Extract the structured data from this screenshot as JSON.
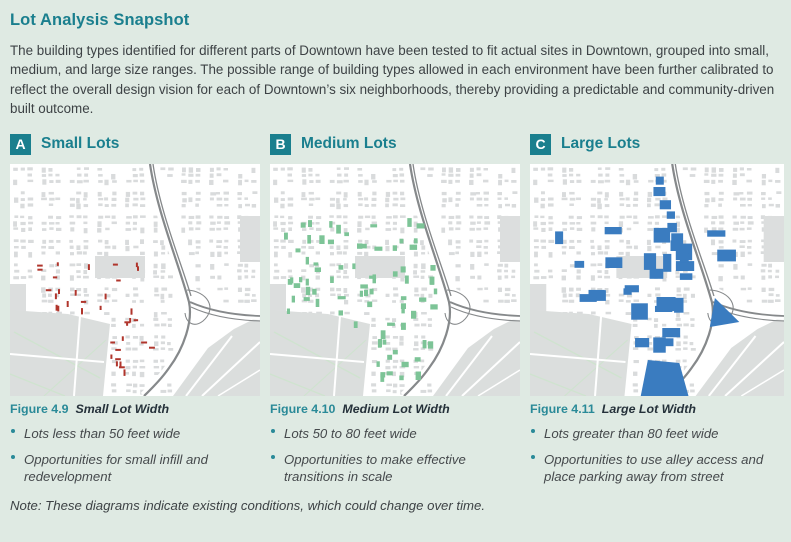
{
  "page": {
    "title": "Lot Analysis Snapshot",
    "intro": "The building types identified for different parts of Downtown have been tested to fit actual sites in Downtown, grouped into small, medium, and large size ranges. The possible range of building types allowed in each environment have been further calibrated to reflect the overall design vision for each of Downtown’s six neighborhoods, thereby providing a predictable and community-driven built outcome.",
    "note": "Note: These diagrams indicate existing conditions, which could change over time."
  },
  "colors": {
    "accent_teal": "#1a7f8e",
    "figure_label_teal": "#2a8a98",
    "page_background": "#dfeae3",
    "map_highlight_red": "#b0352c",
    "map_highlight_green": "#7dc497",
    "map_highlight_blue": "#3a7cc0"
  },
  "sections": [
    {
      "badge": "A",
      "title": "Small Lots",
      "map_type": "small",
      "highlight_color": "#b0352c",
      "figure_label": "Figure 4.9",
      "figure_caption": "Small Lot Width",
      "bullets": [
        "Lots less than 50 feet wide",
        "Opportunities for small infill and redevelopment"
      ]
    },
    {
      "badge": "B",
      "title": "Medium Lots",
      "map_type": "medium",
      "highlight_color": "#7dc497",
      "figure_label": "Figure 4.10",
      "figure_caption": "Medium Lot Width",
      "bullets": [
        "Lots 50 to 80 feet wide",
        "Opportunities to make effective transitions in scale"
      ]
    },
    {
      "badge": "C",
      "title": "Large Lots",
      "map_type": "large",
      "highlight_color": "#3a7cc0",
      "figure_label": "Figure 4.11",
      "figure_caption": "Large Lot Width",
      "bullets": [
        "Lots greater than 80 feet wide",
        "Opportunities to use alley access and place parking away from street"
      ]
    }
  ]
}
